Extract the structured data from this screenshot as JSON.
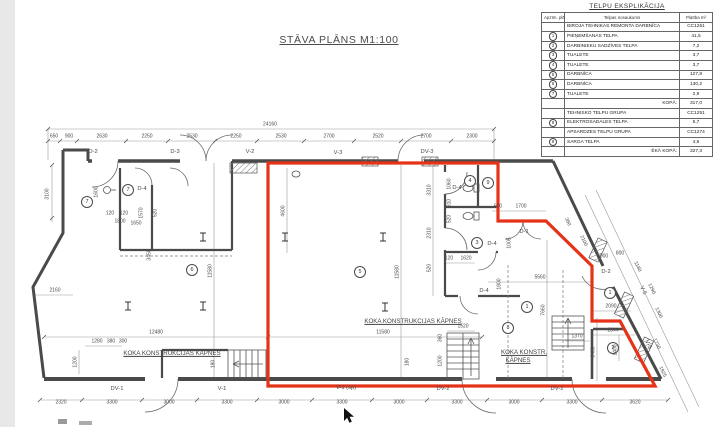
{
  "title": "STĀVA PLĀNS M1:100",
  "colors": {
    "boundary_red": "#e43318",
    "wall_gray": "#4a4a4a"
  },
  "legend_table": {
    "title": "TELPU EKSPLIKĀCIJA",
    "col_headers": [
      "Apzīm. plānā",
      "Telpas nosaukums",
      "Platība m²"
    ],
    "rows": [
      {
        "num": "",
        "name": "BIROJA TEHNIKAS REMONTA DARBNĪCA",
        "area": "CC1251"
      },
      {
        "num": "1",
        "name": "PIEŅEMŠANAS TELPA",
        "area": "41,5"
      },
      {
        "num": "2",
        "name": "DARBINIEKU SADZĪVES TELPA",
        "area": "7,2"
      },
      {
        "num": "3",
        "name": "TUALETE",
        "area": "3,7"
      },
      {
        "num": "4",
        "name": "TUALETE",
        "area": "3,7"
      },
      {
        "num": "5",
        "name": "DARBNĪCA",
        "area": "127,8"
      },
      {
        "num": "6",
        "name": "DARBNĪCA",
        "area": "130,2"
      },
      {
        "num": "7",
        "name": "TUALETE",
        "area": "2,9"
      },
      {
        "num": "",
        "name": "KOPĀ:",
        "area": "317,0"
      },
      {
        "num": "",
        "name": "TEHNISKO TELPU GRUPA",
        "area": "CC1251"
      },
      {
        "num": "8",
        "name": "ELEKTROSADALES TELPA",
        "area": "5,7"
      },
      {
        "num": "",
        "name": "APSARDZES TELPU GRUPA",
        "area": "CC1274"
      },
      {
        "num": "9",
        "name": "SARGA TELPA",
        "area": "4,6"
      },
      {
        "num": "",
        "name": "ĒKĀ KOPĀ:",
        "area": "327,3"
      }
    ]
  },
  "plan": {
    "overall_dim": "24160",
    "dims_top": [
      "650",
      "900",
      "2630",
      "2250",
      "2530",
      "2250",
      "2530",
      "2700",
      "2520",
      "2700",
      "2300"
    ],
    "dims_bottom": [
      "2320",
      "3300",
      "3000",
      "3300",
      "3000",
      "3300",
      "3000",
      "3300",
      "3000",
      "3300",
      "3620"
    ],
    "stair_labels": {
      "left": "KOKA KONSTRUKCIJAS KĀPNES",
      "center": "KOKA KONSTRUKCIJAS KĀPNES",
      "right1": "KOKA KONSTR.",
      "right2": "KĀPNES"
    },
    "labels": {
      "top_d2": "D-2",
      "top_d3": "D-3",
      "top_v2": "V-2",
      "top_v3": "V-3",
      "top_dv3": "DV-3",
      "d4_room7": "D-4",
      "d4_wc4": "D-4",
      "d4_wc3": "D-4",
      "d4_hall": "D-4",
      "d1": "D-1",
      "d2_right": "D-2",
      "v5_upper": "V-5",
      "v5_lower": "V-5",
      "dv1": "DV-1",
      "v1": "V-1",
      "v1sp": "V-1 (sp)",
      "dv2a": "DV-2",
      "dv2b": "DV-2"
    },
    "room_circles": {
      "r7a": "7",
      "r7b": "7",
      "r4": "4",
      "r9": "9",
      "r3": "3",
      "r6": "6",
      "r5": "5",
      "r1a": "1",
      "r1b": "1",
      "r2": "2",
      "r8": "8"
    },
    "dims_misc": {
      "k12480": "12480",
      "k11580a": "11580",
      "k11580b": "11580",
      "k11580c": "11580",
      "k4600": "4600",
      "k7660": "7660",
      "k5560": "5560",
      "k2090": "2090",
      "k2344": "2344",
      "k1370": "1370",
      "k3400": "3400",
      "k1400": "1400",
      "k3100": "3100",
      "k1600": "1600",
      "k1650": "1650",
      "k2160": "2160",
      "k120a": "120",
      "k120b": "120",
      "k1800a": "1800",
      "k1570": "1570",
      "k520a": "520",
      "k3450": "3450",
      "k3310": "3310",
      "k2310": "2310",
      "k520b": "520",
      "k1060": "1060",
      "k810": "810",
      "k520c": "520",
      "k120c": "120",
      "k1620": "1620",
      "k600": "600",
      "k1700": "1700",
      "k1005": "1005",
      "k1800b": "1800",
      "k1280": "1280",
      "k380": "380",
      "k300": "300",
      "k1200a": "1200",
      "k180a": "180",
      "k1520": "1520",
      "k360a": "360",
      "k1200b": "1200",
      "k180b": "180",
      "k360d": "360",
      "k2100": "2100",
      "k900": "900",
      "k800": "800",
      "k1180": "1180",
      "k1290": "1290",
      "k1300": "1300",
      "k1730": "1730",
      "k1925": "1925"
    }
  }
}
